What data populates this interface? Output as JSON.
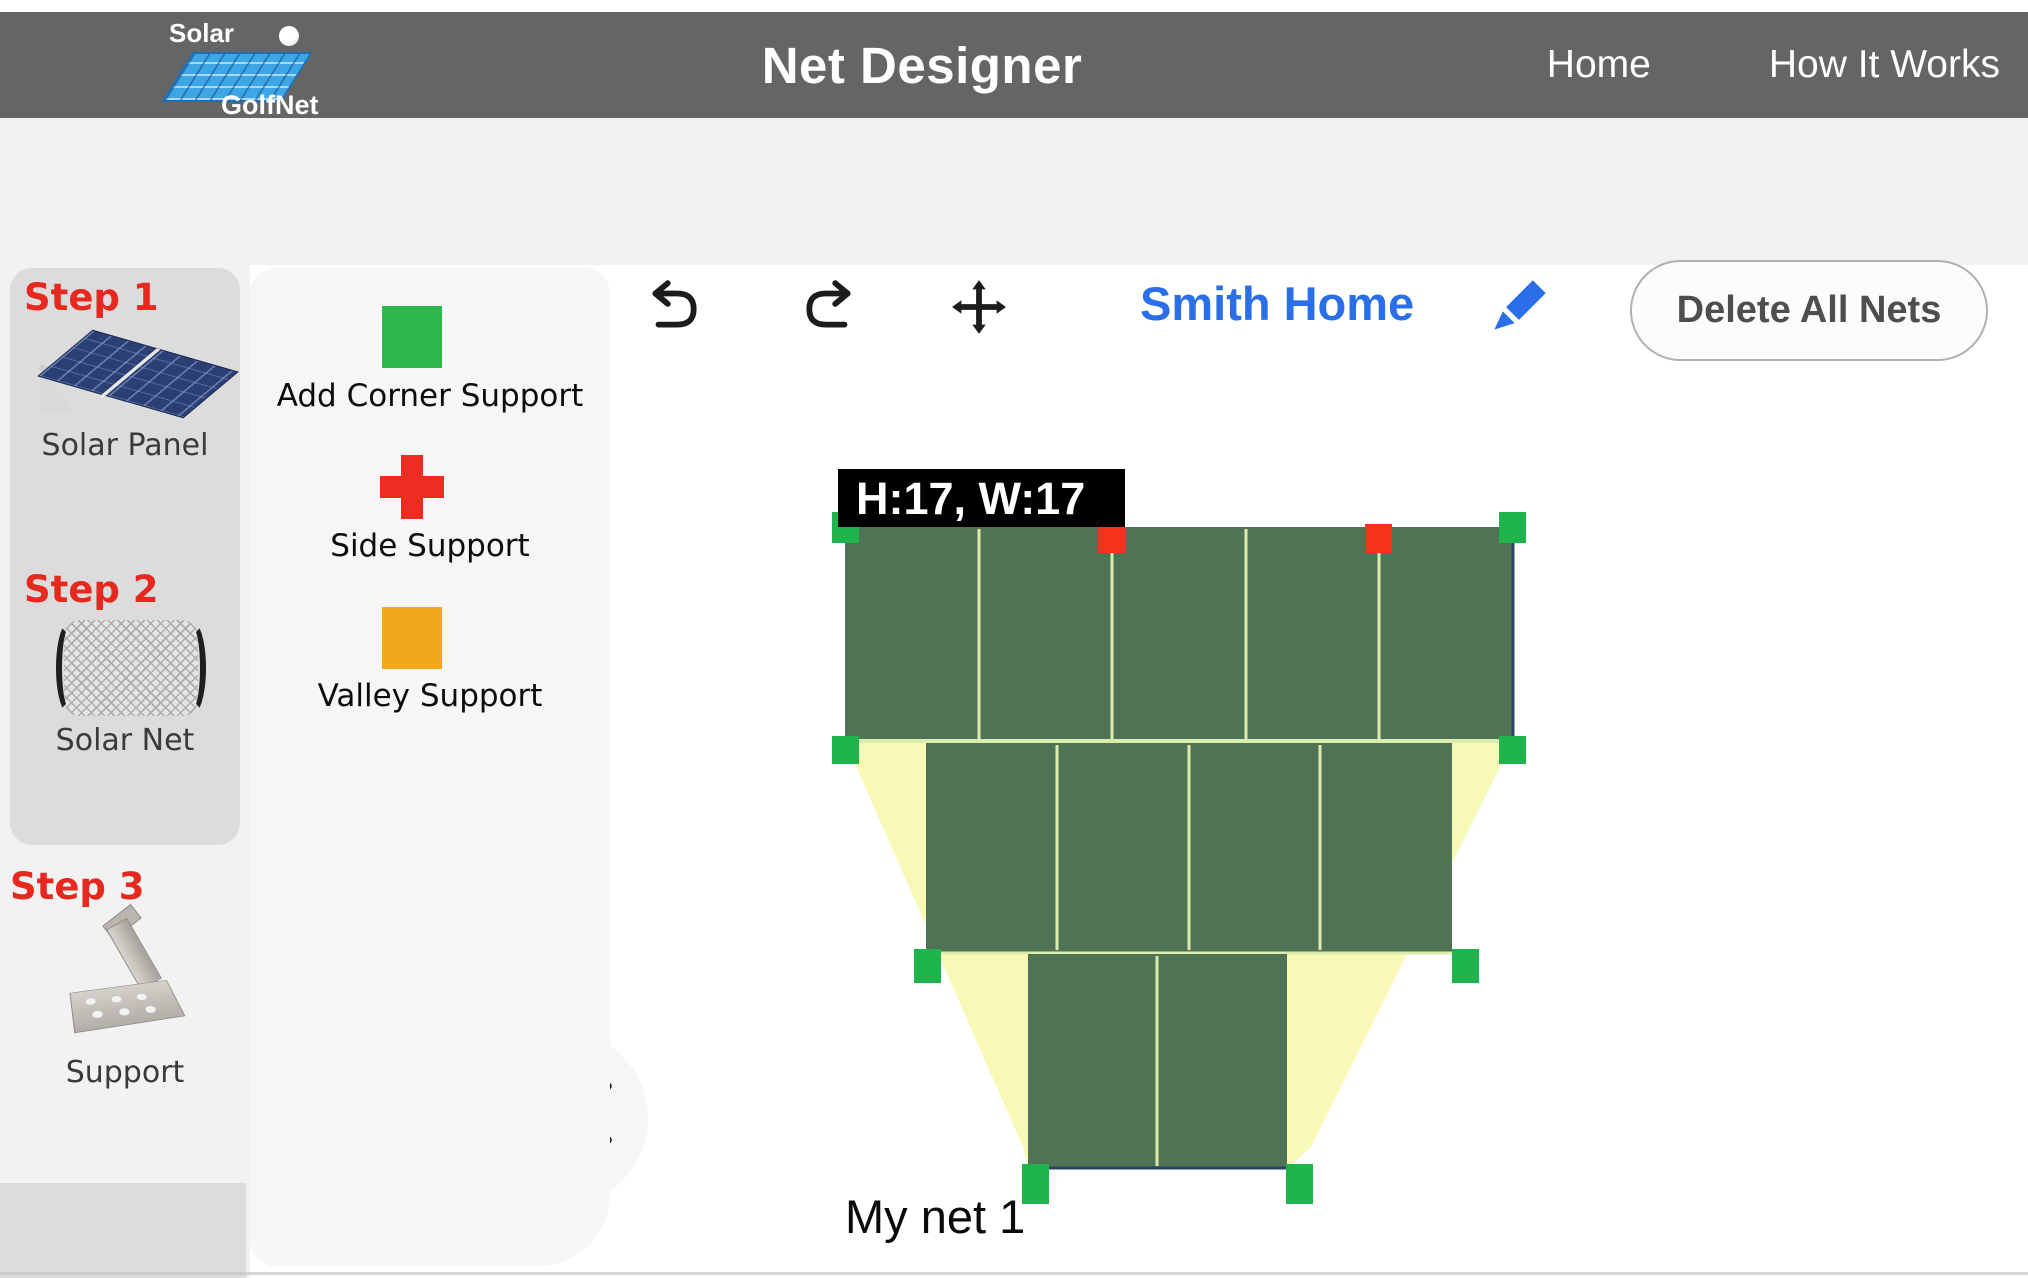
{
  "header": {
    "logo": {
      "line1": "Solar",
      "line2": "GolfNet"
    },
    "title": "Net Designer",
    "nav": [
      {
        "label": "Home"
      },
      {
        "label": "How It Works"
      }
    ]
  },
  "toolbar": {
    "icons": [
      {
        "name": "home"
      },
      {
        "name": "zoom-in"
      },
      {
        "name": "zoom-out"
      },
      {
        "name": "reset-zoom"
      },
      {
        "name": "undo"
      },
      {
        "name": "redo"
      },
      {
        "name": "move"
      }
    ],
    "project_name": "Smith Home",
    "delete_button_label": "Delete All Nets"
  },
  "sidebar": {
    "steps": [
      {
        "label": "Step 1",
        "item": "Solar Panel"
      },
      {
        "label": "Step 2",
        "item": "Solar Net"
      },
      {
        "label": "Step 3",
        "item": "Support"
      }
    ]
  },
  "tools": {
    "items": [
      {
        "label": "Add Corner Support",
        "shape": "square",
        "color": "#2db84c"
      },
      {
        "label": "Side Support",
        "shape": "plus",
        "color": "#ee2d22"
      },
      {
        "label": "Valley Support",
        "shape": "square",
        "color": "#f0a71b"
      }
    ],
    "collapse_icon": "chevron-left"
  },
  "canvas": {
    "net": {
      "name": "My net 1",
      "size_label": "H:17, W:17",
      "height": 17,
      "width": 17,
      "rows": [
        {
          "panels": 5
        },
        {
          "panels": 4
        },
        {
          "panels": 2
        }
      ],
      "colors": {
        "panel_green": "#4f7354",
        "gap_yellow": "#f8f9b7",
        "grid_line": "#dcebae",
        "outline": "#2a4468",
        "corner_handle_green": "#1db44b",
        "side_handle_red": "#f5331c"
      }
    }
  }
}
